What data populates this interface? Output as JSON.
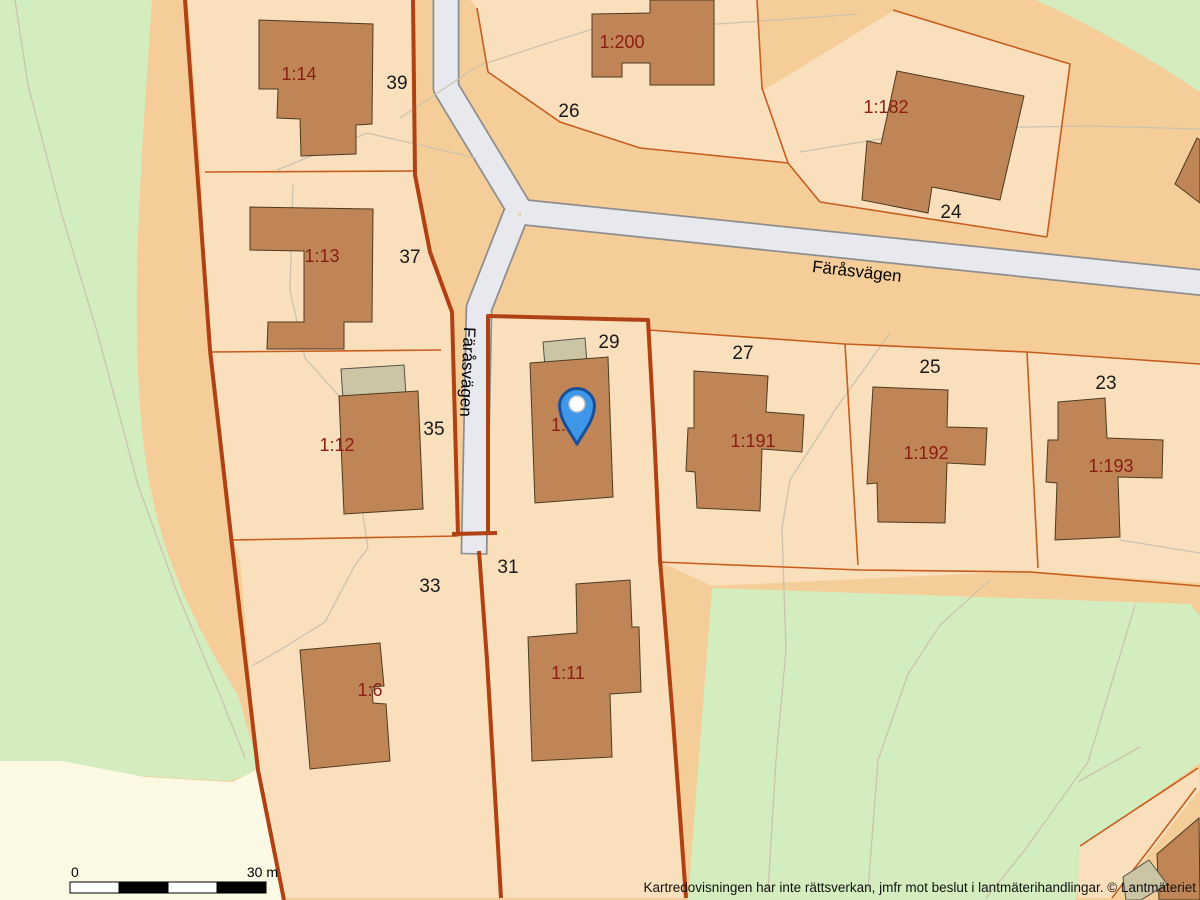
{
  "map": {
    "road": {
      "name": "Färåsvägen"
    },
    "parcels": [
      {
        "label": "1:14",
        "address": "39"
      },
      {
        "label": "1:13",
        "address": "37"
      },
      {
        "label": "1:12",
        "address": "35"
      },
      {
        "label": "1:6",
        "address": "33"
      },
      {
        "label": "1:11",
        "address": "31"
      },
      {
        "label": "1:",
        "address": "29"
      },
      {
        "label": "1:200",
        "address": "26"
      },
      {
        "label": "1:182",
        "address": "24"
      },
      {
        "label": "1:191",
        "address": "27"
      },
      {
        "label": "1:192",
        "address": "25"
      },
      {
        "label": "1:193",
        "address": "23"
      }
    ],
    "marker": {
      "type": "location-pin",
      "fill": "#3e97e9",
      "outline": "#1a4f96"
    },
    "scale_bar": {
      "start_label": "0",
      "end_label": "30 m"
    },
    "colors": {
      "parcel_fill": "#f9dfbc",
      "block_fill": "#f5cd98",
      "green_area": "#d3edbf",
      "open_area": "#fbf9e4",
      "road_fill": "#e8e8ef",
      "boundary_major": "#b04112",
      "boundary_minor": "#c75d1f",
      "building_fill": "#c08557",
      "outbuilding_fill": "#cbc5a6",
      "parcel_label_color": "#8b1c12"
    }
  },
  "footer": {
    "disclaimer": "Kartredovisningen har inte rättsverkan, jmfr mot beslut i lantmäterihandlingar. © Lantmäteriet"
  }
}
